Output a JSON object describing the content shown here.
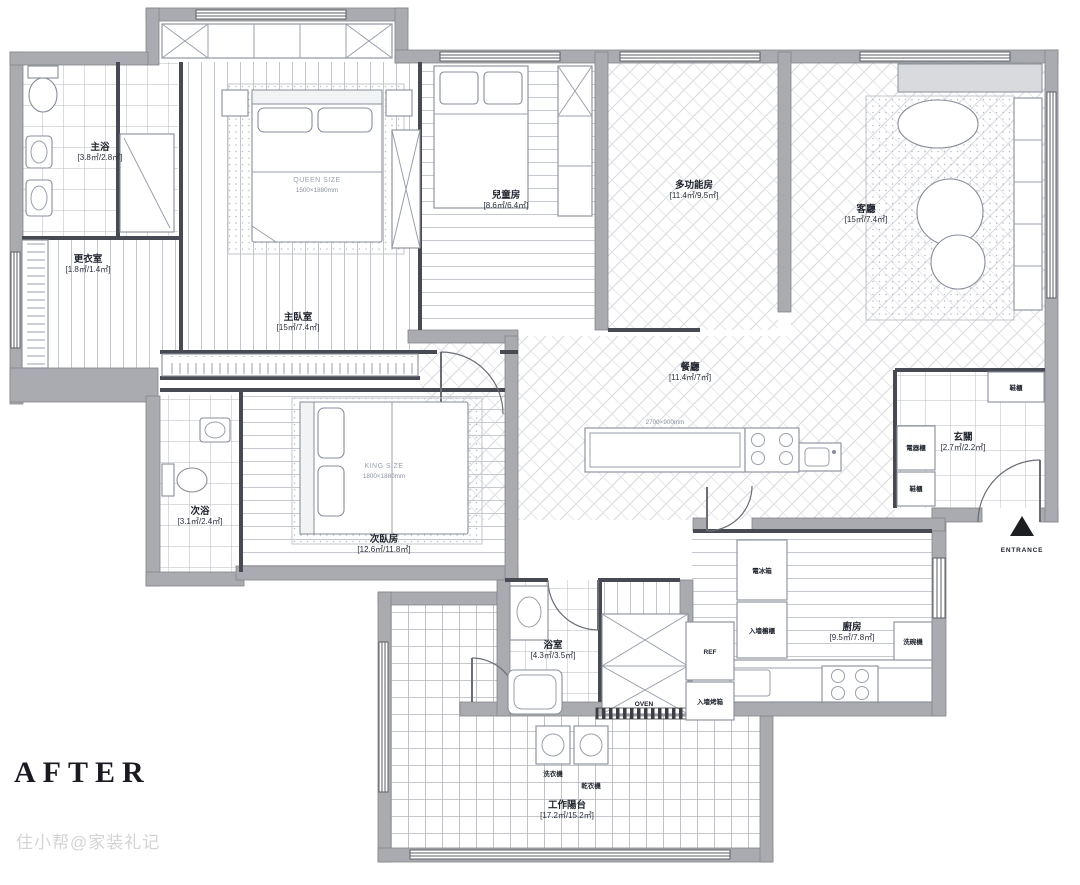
{
  "page": {
    "after_label": "AFTER",
    "watermark": "住小帮@家装礼记"
  },
  "palette": {
    "wall": "#a9abb0",
    "interior_line": "#474a52",
    "hatch": "#c5c7cd",
    "label_text": "#20242e"
  },
  "rooms": {
    "master_bath": {
      "name": "主浴",
      "area": "[3.8㎡/2.8㎡]"
    },
    "dressing": {
      "name": "更衣室",
      "area": "[1.8㎡/1.4㎡]"
    },
    "master_bedroom": {
      "name": "主臥室",
      "area": "[15㎡/7.4㎡]"
    },
    "kids_room": {
      "name": "兒童房",
      "area": "[8.6㎡/6.4㎡]"
    },
    "multi_room": {
      "name": "多功能房",
      "area": "[11.4㎡/9.5㎡]"
    },
    "living": {
      "name": "客廳",
      "area": "[15㎡/7.4㎡]"
    },
    "dining": {
      "name": "餐廳",
      "area": "[11.4㎡/7㎡]"
    },
    "second_bedroom": {
      "name": "次臥房",
      "area": "[12.6㎡/11.8㎡]"
    },
    "second_bath": {
      "name": "次浴",
      "area": "[3.1㎡/2.4㎡]"
    },
    "bathroom": {
      "name": "浴室",
      "area": "[4.3㎡/3.5㎡]"
    },
    "kitchen": {
      "name": "廚房",
      "area": "[9.5㎡/7.8㎡]"
    },
    "entry": {
      "name": "玄關",
      "area": "[2.7㎡/2.2㎡]"
    },
    "balcony": {
      "name": "工作陽台",
      "area": "[17.2㎡/15.2㎡]"
    }
  },
  "furniture": {
    "master_bed_type": "QUEEN SIZE",
    "master_bed_dim": "1500×1880mm",
    "second_bed_type": "KING SIZE",
    "second_bed_dim": "1800×1880mm",
    "island_dim": "2700×900mm",
    "fridge": "REF",
    "oven": "OVEN",
    "tall_fridge": "電冰箱",
    "wall_cabinet": "入墻櫥櫃",
    "wall_oven": "入墻烤箱",
    "dishwasher": "洗碗機",
    "washer": "洗衣機",
    "dryer": "乾衣機",
    "appliance_cabinet": "電器櫃",
    "shoe_cabinet_top": "鞋櫃",
    "shoe_cabinet_side": "鞋櫃"
  },
  "entrance": {
    "label": "ENTRANCE"
  }
}
